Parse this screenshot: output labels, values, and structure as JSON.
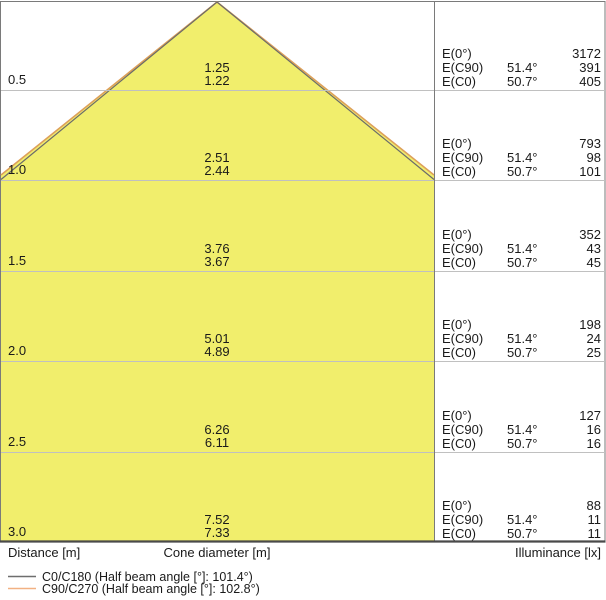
{
  "colors": {
    "cone_fill": "#f1ee6c",
    "c0_line": "#6b6b6b",
    "c90_line": "#dda05a",
    "legend_c0_swatch": "#6e6e6e",
    "legend_c90_swatch": "#f2b183",
    "grid_line": "#c0c0c0",
    "frame": "#7a7a7a"
  },
  "axis": {
    "distance_label": "Distance [m]",
    "cone_diameter_label": "Cone diameter [m]",
    "illuminance_label": "Illuminance [lx]"
  },
  "labels": {
    "e0": "E(0°)",
    "ec90": "E(C90)",
    "ec0": "E(C0)"
  },
  "legend": {
    "c0_label": "C0/C180 (Half beam angle [°]: 101.4°)",
    "c90_label": "C90/C270 (Half beam angle [°]: 102.8°)"
  },
  "rows": [
    {
      "distance": "0.5",
      "cone_c90": "1.25",
      "cone_c0": "1.22",
      "e0": "3172",
      "ec90_angle": "51.4°",
      "ec90": "391",
      "ec0_angle": "50.7°",
      "ec0": "405"
    },
    {
      "distance": "1.0",
      "cone_c90": "2.51",
      "cone_c0": "2.44",
      "e0": "793",
      "ec90_angle": "51.4°",
      "ec90": "98",
      "ec0_angle": "50.7°",
      "ec0": "101"
    },
    {
      "distance": "1.5",
      "cone_c90": "3.76",
      "cone_c0": "3.67",
      "e0": "352",
      "ec90_angle": "51.4°",
      "ec90": "43",
      "ec0_angle": "50.7°",
      "ec0": "45"
    },
    {
      "distance": "2.0",
      "cone_c90": "5.01",
      "cone_c0": "4.89",
      "e0": "198",
      "ec90_angle": "51.4°",
      "ec90": "24",
      "ec0_angle": "50.7°",
      "ec0": "25"
    },
    {
      "distance": "2.5",
      "cone_c90": "6.26",
      "cone_c0": "6.11",
      "e0": "127",
      "ec90_angle": "51.4°",
      "ec90": "16",
      "ec0_angle": "50.7°",
      "ec0": "16"
    },
    {
      "distance": "3.0",
      "cone_c90": "7.52",
      "cone_c0": "7.33",
      "e0": "88",
      "ec90_angle": "51.4°",
      "ec90": "11",
      "ec0_angle": "50.7°",
      "ec0": "11"
    }
  ],
  "chart_data": {
    "type": "area",
    "title": "Light cone diagram (luminaire datasheet)",
    "xlabel": "Cone diameter [m]",
    "ylabel": "Distance [m]",
    "ylabel_right": "Illuminance [lx]",
    "legend_position": "bottom-left",
    "grid": true,
    "legend": [
      "C0/C180 (Half beam angle [°]: 101.4°)",
      "C90/C270 (Half beam angle [°]: 102.8°)"
    ],
    "half_beam_angles_deg": {
      "C0_C180": 101.4,
      "C90_C270": 102.8
    },
    "distances_m": [
      0.5,
      1.0,
      1.5,
      2.0,
      2.5,
      3.0
    ],
    "series": [
      {
        "name": "Cone diameter C90/C270 [m]",
        "values": [
          1.25,
          2.51,
          3.76,
          5.01,
          6.26,
          7.52
        ]
      },
      {
        "name": "Cone diameter C0/C180 [m]",
        "values": [
          1.22,
          2.44,
          3.67,
          4.89,
          6.11,
          7.33
        ]
      },
      {
        "name": "E(0°) [lx]",
        "values": [
          3172,
          793,
          352,
          198,
          127,
          88
        ]
      },
      {
        "name": "E(C90) [lx]",
        "values": [
          391,
          98,
          43,
          24,
          16,
          11
        ]
      },
      {
        "name": "E(C90) angle [°]",
        "values": [
          51.4,
          51.4,
          51.4,
          51.4,
          51.4,
          51.4
        ]
      },
      {
        "name": "E(C0) [lx]",
        "values": [
          405,
          101,
          45,
          25,
          16,
          11
        ]
      },
      {
        "name": "E(C0) angle [°]",
        "values": [
          50.7,
          50.7,
          50.7,
          50.7,
          50.7,
          50.7
        ]
      }
    ]
  }
}
